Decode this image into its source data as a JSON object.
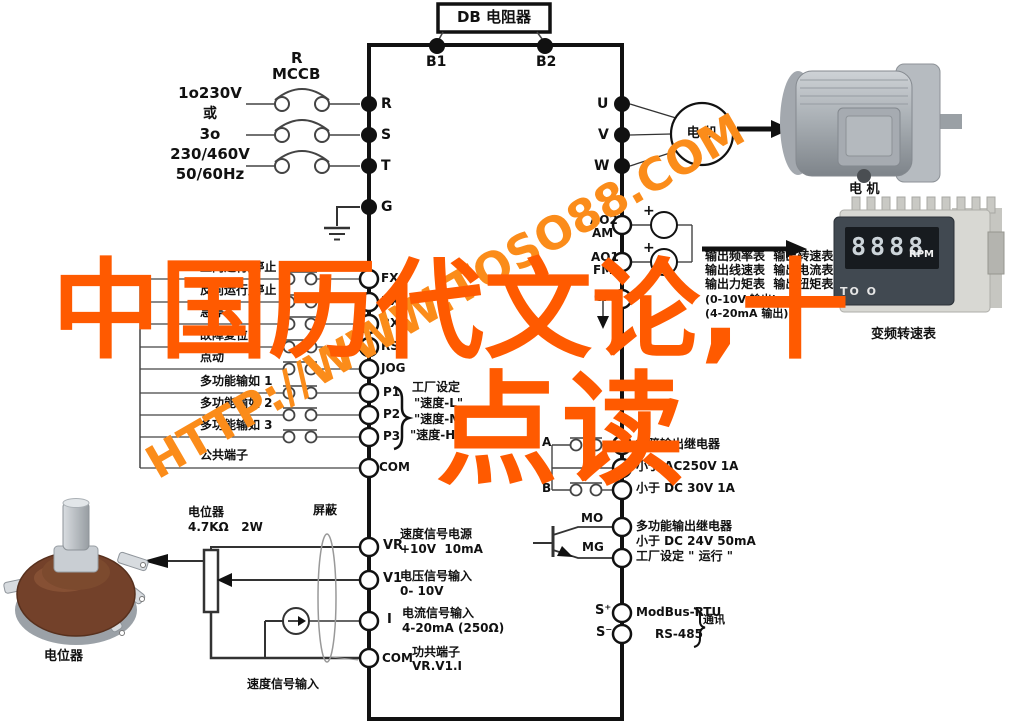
{
  "watermark": {
    "url": "HTTP://WWW.TQSO88.COM",
    "line1": "中国历代文论,十",
    "line2": "点读"
  },
  "top": {
    "db_box": "DB 电阻器",
    "b1": "B1",
    "b2": "B2"
  },
  "power": {
    "lines": [
      "1o230V",
      "或",
      "3o",
      "230/460V",
      "50/60Hz"
    ],
    "mccb_top": "R",
    "mccb": "MCCB"
  },
  "main_terminals": {
    "r": "R",
    "s": "S",
    "t": "T",
    "g": "G",
    "u": "U",
    "v": "V",
    "w": "W"
  },
  "inputs": {
    "rows": [
      {
        "label": "正向运行/停止",
        "terminal": "FX"
      },
      {
        "label": "反向运行/停止",
        "terminal": "RX"
      },
      {
        "label": "急停",
        "terminal": "BX"
      },
      {
        "label": "故障复位",
        "terminal": "RST"
      },
      {
        "label": "点动",
        "terminal": "JOG"
      },
      {
        "label": "多功能输如 1",
        "terminal": "P1"
      },
      {
        "label": "多功能输如 2",
        "terminal": "P2"
      },
      {
        "label": "多功能输如 3",
        "terminal": "P3"
      },
      {
        "label": "公共端子",
        "terminal": "COM"
      }
    ],
    "pgroup": {
      "setting": "工厂设定",
      "s1": "\"速度-L\"",
      "s2": "\"速度-M\"",
      "s3": "\"速度-H\""
    }
  },
  "analog_in": {
    "pot_label": "电位器",
    "pot_spec": "4.7KΩ   2W",
    "shield": "屏蔽",
    "vr": {
      "t": "VR",
      "l1": "速度信号电源",
      "l2": "+10V  10mA"
    },
    "v1": {
      "t": "V1",
      "l1": "电压信号输入",
      "l2": "0- 10V"
    },
    "i": {
      "t": "I",
      "l1": "电流信号输入",
      "l2": "4-20mA (250Ω)"
    },
    "com": {
      "t": "COM",
      "l1": "功共端子",
      "l2": "VR.V1.I"
    },
    "speed_input": "速度信号输入",
    "pot_photo_label": "电位器"
  },
  "analog_out": {
    "ao2": "AO2",
    "am": "AM",
    "ao1": "AO1",
    "fm": "FM",
    "cm": "CM",
    "plus1": "+",
    "plus2": "+",
    "lines": [
      "输出频率表  输出转速表",
      "输出线速表  输出电流表",
      "输出力矩表  输出扭矩表",
      "(0-10V 输出)",
      "(4-20mA 输出)"
    ]
  },
  "relay": {
    "a": "A",
    "b": "B",
    "lines": [
      "故障输出继电器",
      "小于 AC250V 1A",
      "小于 DC 30V 1A"
    ]
  },
  "mo_out": {
    "mo": "MO",
    "mg": "MG",
    "lines": [
      "多功能输出继电器",
      "小于 DC 24V 50mA",
      "工厂设定 \" 运行 \""
    ]
  },
  "comm": {
    "sp": "S⁺",
    "sm": "S⁻",
    "modbus": "ModBus-RTU",
    "rs485": "RS-485",
    "label": "通讯"
  },
  "motor": {
    "circle": "电 机",
    "photo_label": "电 机"
  },
  "rpm": {
    "display": "8888",
    "unit": "RPM",
    "brand": "TO O",
    "label": "变频转速表"
  }
}
